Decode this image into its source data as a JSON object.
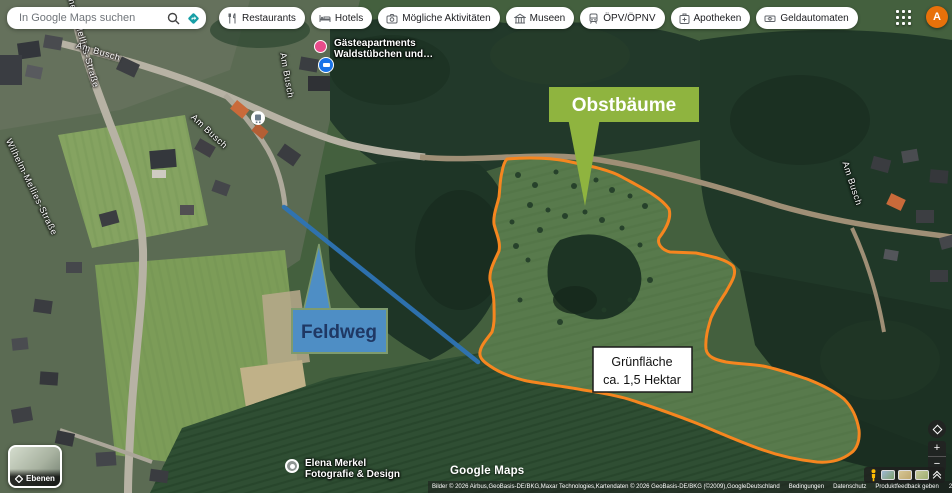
{
  "topbar": {
    "search_placeholder": "In Google Maps suchen",
    "categories": [
      {
        "label": "Restaurants",
        "icon": "restaurant-icon"
      },
      {
        "label": "Hotels",
        "icon": "hotel-icon"
      },
      {
        "label": "Mögliche Aktivitäten",
        "icon": "camera-icon"
      },
      {
        "label": "Museen",
        "icon": "museum-icon"
      },
      {
        "label": "ÖPV/ÖPNV",
        "icon": "transit-icon"
      },
      {
        "label": "Apotheken",
        "icon": "pharmacy-icon"
      },
      {
        "label": "Geldautomaten",
        "icon": "atm-icon"
      }
    ],
    "avatar_letter": "A"
  },
  "map": {
    "street_labels": [
      {
        "text": "Wilhelm-Mellies-Straße"
      },
      {
        "text": "Wilhelm-Mellies-Straße"
      },
      {
        "text": "Am Busch"
      },
      {
        "text": "Am Busch"
      },
      {
        "text": "Am Busch"
      },
      {
        "text": "Am Busch"
      }
    ],
    "pois": {
      "guest_apartments": {
        "line1": "Gästeapartments",
        "line2": "Waldstübchen und…"
      },
      "photographer": {
        "line1": "Elena Merkel",
        "line2": "Fotografie & Design"
      }
    },
    "annotations": {
      "obstbaeume": {
        "label": "Obstbäume",
        "fill": "#8FB43F",
        "text_color": "#FFFFFF"
      },
      "feldweg": {
        "label": "Feldweg",
        "fill": "#4E8EC5",
        "border": "#7E9B6E",
        "text_color": "#1F3864"
      },
      "gruenflaeche": {
        "line1": "Grünfläche",
        "line2": "ca. 1,5 Hektar"
      },
      "area_outline_color": "#F6861F",
      "path_line_color": "#2E74B5"
    }
  },
  "controls": {
    "layers_label": "Ebenen",
    "zoom_in_label": "+",
    "zoom_out_label": "−"
  },
  "footer": {
    "logo_text": "Google Maps",
    "attribution": "Bilder © 2026 Airbus,GeoBasis-DE/BKG,Maxar Technologies,Kartendaten © 2026 GeoBasis-DE/BKG (©2009),Google",
    "links": [
      "Deutschland",
      "Bedingungen",
      "Datenschutz",
      "Produktfeedback geben"
    ],
    "scale_label": "20 m"
  }
}
